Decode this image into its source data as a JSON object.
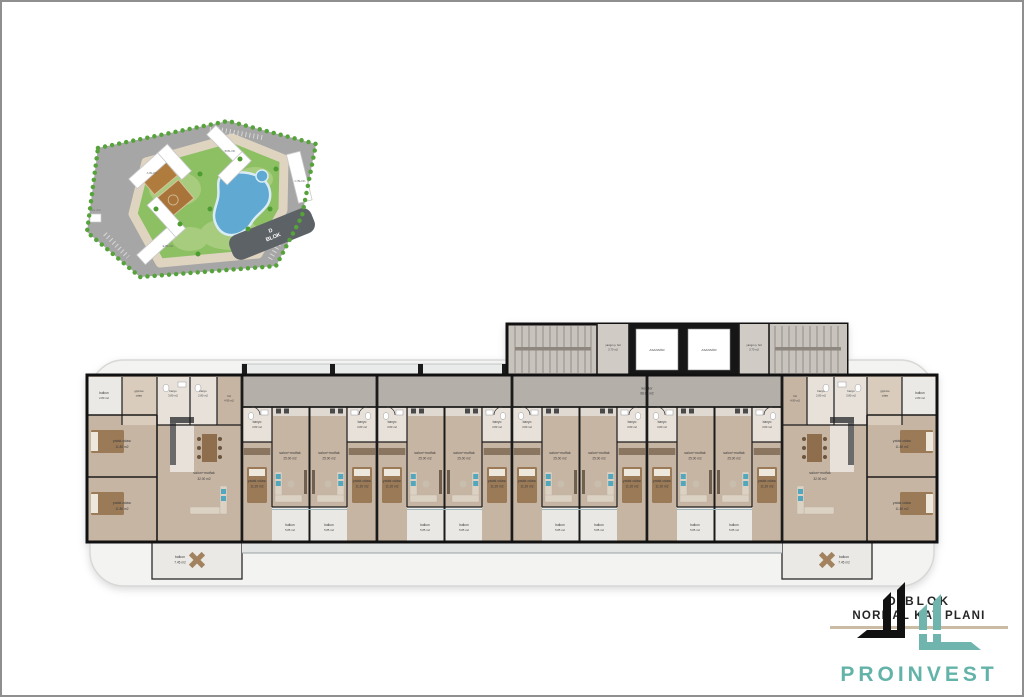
{
  "site_plan": {
    "blocks": {
      "a": "A BLOK",
      "b": "B BLOK",
      "c": "C BLOK",
      "e": "E BLOK"
    },
    "d_block": {
      "line1": "D",
      "line2": "BLOK"
    },
    "office_label": "site ofisi"
  },
  "floor_plan": {
    "core": {
      "elevator": "ASANSÖR",
      "fire_hall": "yangın ş. hol",
      "fire_hall_area": "3.70 m2",
      "corridor": "koridor",
      "corridor_area": "68.00 m2"
    },
    "middle_unit": {
      "salon": "salon+mutfak",
      "salon_area": "25.00 m2",
      "bedroom": "yatak odası",
      "bedroom_area": "11.20 m2",
      "bath": "banyo",
      "bath_area": "3.80 m2",
      "balcony": "balkon",
      "balcony_area": "5.85 m2"
    },
    "end_apartment": {
      "balcony_small": "balkon",
      "balcony_small_area": "2.80 m2",
      "dressing1": "giyinme",
      "dressing2": "odası",
      "bath1": "banyo",
      "bath1_area": "3.80 m2",
      "bath2": "banyo",
      "bath2_area": "2.80 m2",
      "hall": "hol",
      "hall_area": "4.90 m2",
      "bedroom1": "yatak odası",
      "bedroom1_area": "11.80 m2",
      "bedroom2": "yatak odası",
      "bedroom2_area": "11.80 m2",
      "salon": "salon+mutfak",
      "salon_area": "32.00 m2",
      "balcony_large": "balkon",
      "balcony_large_area": "7.45 m2"
    }
  },
  "branding": {
    "block_title": "D BLOK",
    "plan_title": "NORMAL KAT PLANI",
    "company": "PROINVEST",
    "teal": "#63b3a9",
    "rule_color": "#c9bba4"
  }
}
